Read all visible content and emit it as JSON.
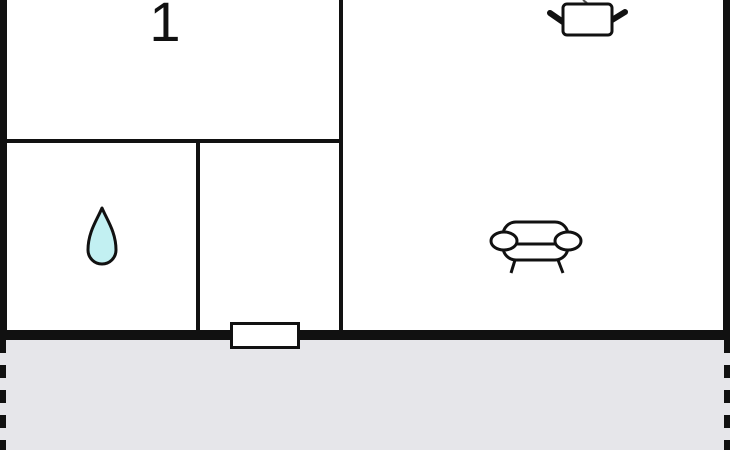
{
  "floor_plan": {
    "rooms": {
      "room1": {
        "label": "1"
      }
    },
    "icons": {
      "water_drop": {
        "name": "water-drop-icon"
      },
      "cooking_pot": {
        "name": "cooking-pot-icon"
      },
      "sofa": {
        "name": "sofa-icon"
      }
    },
    "colors": {
      "wall": "#111111",
      "room_fill": "#ffffff",
      "terrace_fill": "#e6e6ea",
      "water_drop_fill": "#c2f0f2",
      "outline": "#111111"
    }
  }
}
